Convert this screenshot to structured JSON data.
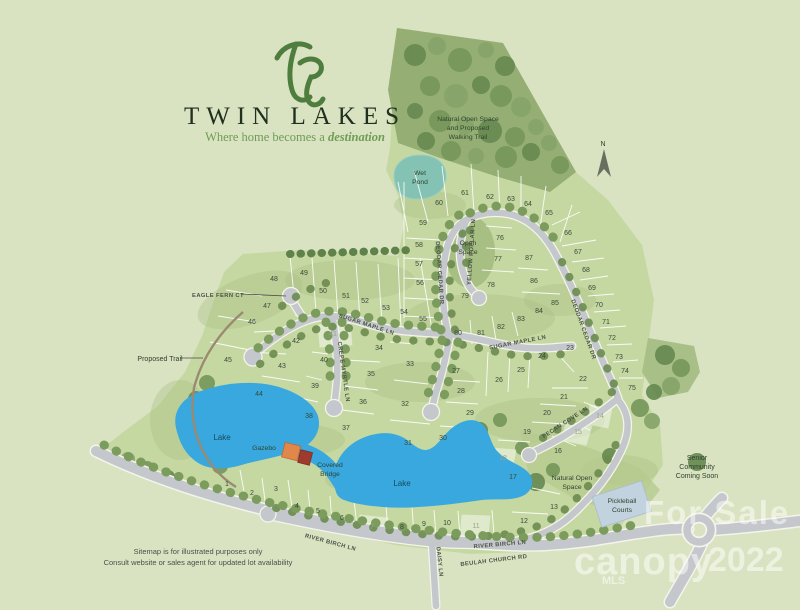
{
  "branding": {
    "name": "TWIN LAKES",
    "tagline_prefix": "Where home becomes a ",
    "tagline_emphasis": "destination"
  },
  "compass": {
    "north": "N"
  },
  "labels": {
    "natural_open_trail": [
      "Natural Open Space",
      "and Proposed",
      "Walking Trail"
    ],
    "wet_pond": [
      "Wet",
      "Pond"
    ],
    "open_space": [
      "Open",
      "Space"
    ],
    "natural_open_south": [
      "Natural Open",
      "Space"
    ],
    "lake_west": "Lake",
    "lake_east": "Lake",
    "gazebo": "Gazebo",
    "covered_bridge": [
      "Covered",
      "Bridge"
    ],
    "pickleball": [
      "Pickleball",
      "Courts"
    ],
    "senior": [
      "Senior",
      "Community",
      "Coming Soon"
    ],
    "proposed_trail": "Proposed Trail",
    "eagle_fern": "EAGLE FERN CT"
  },
  "streets": {
    "sugar_maple": "SUGAR MAPLE LN",
    "crepe_myrtle": "CREPE MYRTLE LN",
    "deodar_cedar": "DEODAR CEDAR DR",
    "yellow_poplar": "YELLOW POPLAR LN",
    "pecan_cove": "PECAN COVE LN",
    "river_birch": "RIVER BIRCH LN",
    "beulah_church": "BEULAH CHURCH RD",
    "daisy": "DAISY LN"
  },
  "disclaimer": [
    "Sitemap is for illustrated purposes only",
    "Consult website or sales agent for updated lot availability"
  ],
  "watermark": {
    "line1": "For Sale",
    "brand": "canopy",
    "year": "2022",
    "sub": "MLS"
  },
  "colors": {
    "background": "#d9e3c1",
    "site_green": "#c6d8a2",
    "forest_green": "#95ae74",
    "lake_blue": "#38a8de",
    "wet_pond_teal": "#84c3b3",
    "road_gray": "#c4c7cb",
    "logo_green": "#4e7d3e",
    "gazebo_orange": "#e2874a",
    "bridge_red": "#9e3b2e",
    "pickleball_blue": "#c2d2de"
  },
  "map": {
    "lots": [
      {
        "n": 1,
        "x": 227,
        "y": 484
      },
      {
        "n": 2,
        "x": 252,
        "y": 493
      },
      {
        "n": 3,
        "x": 276,
        "y": 489
      },
      {
        "n": 4,
        "x": 297,
        "y": 506
      },
      {
        "n": 5,
        "x": 318,
        "y": 511
      },
      {
        "n": 6,
        "x": 342,
        "y": 518
      },
      {
        "n": 7,
        "x": 372,
        "y": 527,
        "light": true
      },
      {
        "n": 8,
        "x": 402,
        "y": 527
      },
      {
        "n": 9,
        "x": 424,
        "y": 524
      },
      {
        "n": 10,
        "x": 447,
        "y": 523
      },
      {
        "n": 11,
        "x": 476,
        "y": 526,
        "light": true
      },
      {
        "n": 12,
        "x": 524,
        "y": 521
      },
      {
        "n": 13,
        "x": 554,
        "y": 507
      },
      {
        "n": 14,
        "x": 600,
        "y": 416,
        "light": true
      },
      {
        "n": 15,
        "x": 578,
        "y": 432,
        "light": true
      },
      {
        "n": 16,
        "x": 558,
        "y": 451
      },
      {
        "n": 17,
        "x": 513,
        "y": 477
      },
      {
        "n": 18,
        "x": 503,
        "y": 458,
        "light": true
      },
      {
        "n": 19,
        "x": 527,
        "y": 432
      },
      {
        "n": 20,
        "x": 547,
        "y": 413
      },
      {
        "n": 21,
        "x": 564,
        "y": 397
      },
      {
        "n": 22,
        "x": 583,
        "y": 379
      },
      {
        "n": 23,
        "x": 570,
        "y": 348
      },
      {
        "n": 24,
        "x": 542,
        "y": 356
      },
      {
        "n": 25,
        "x": 521,
        "y": 370
      },
      {
        "n": 26,
        "x": 499,
        "y": 380
      },
      {
        "n": 27,
        "x": 456,
        "y": 371
      },
      {
        "n": 28,
        "x": 461,
        "y": 391
      },
      {
        "n": 29,
        "x": 470,
        "y": 413
      },
      {
        "n": 30,
        "x": 443,
        "y": 438
      },
      {
        "n": 31,
        "x": 408,
        "y": 443
      },
      {
        "n": 32,
        "x": 405,
        "y": 404
      },
      {
        "n": 33,
        "x": 410,
        "y": 364
      },
      {
        "n": 34,
        "x": 379,
        "y": 348
      },
      {
        "n": 35,
        "x": 371,
        "y": 374
      },
      {
        "n": 36,
        "x": 363,
        "y": 402
      },
      {
        "n": 37,
        "x": 346,
        "y": 428
      },
      {
        "n": 38,
        "x": 309,
        "y": 416
      },
      {
        "n": 39,
        "x": 315,
        "y": 386
      },
      {
        "n": 40,
        "x": 324,
        "y": 360
      },
      {
        "n": 41,
        "x": 333,
        "y": 334,
        "light": true
      },
      {
        "n": 42,
        "x": 296,
        "y": 341
      },
      {
        "n": 43,
        "x": 282,
        "y": 366
      },
      {
        "n": 44,
        "x": 259,
        "y": 394
      },
      {
        "n": 45,
        "x": 228,
        "y": 360
      },
      {
        "n": 46,
        "x": 252,
        "y": 322
      },
      {
        "n": 47,
        "x": 267,
        "y": 306
      },
      {
        "n": 48,
        "x": 274,
        "y": 279
      },
      {
        "n": 49,
        "x": 304,
        "y": 273
      },
      {
        "n": 50,
        "x": 323,
        "y": 291
      },
      {
        "n": 51,
        "x": 346,
        "y": 296
      },
      {
        "n": 52,
        "x": 365,
        "y": 301
      },
      {
        "n": 53,
        "x": 386,
        "y": 308
      },
      {
        "n": 54,
        "x": 404,
        "y": 312
      },
      {
        "n": 55,
        "x": 423,
        "y": 319
      },
      {
        "n": 56,
        "x": 420,
        "y": 283
      },
      {
        "n": 57,
        "x": 419,
        "y": 264
      },
      {
        "n": 58,
        "x": 419,
        "y": 245
      },
      {
        "n": 59,
        "x": 423,
        "y": 223
      },
      {
        "n": 60,
        "x": 439,
        "y": 203
      },
      {
        "n": 61,
        "x": 465,
        "y": 193
      },
      {
        "n": 62,
        "x": 490,
        "y": 197
      },
      {
        "n": 63,
        "x": 511,
        "y": 199
      },
      {
        "n": 64,
        "x": 528,
        "y": 204
      },
      {
        "n": 65,
        "x": 549,
        "y": 213
      },
      {
        "n": 66,
        "x": 568,
        "y": 233
      },
      {
        "n": 67,
        "x": 578,
        "y": 252
      },
      {
        "n": 68,
        "x": 586,
        "y": 270
      },
      {
        "n": 69,
        "x": 592,
        "y": 288
      },
      {
        "n": 70,
        "x": 599,
        "y": 305
      },
      {
        "n": 71,
        "x": 606,
        "y": 322
      },
      {
        "n": 72,
        "x": 612,
        "y": 338
      },
      {
        "n": 73,
        "x": 619,
        "y": 357
      },
      {
        "n": 74,
        "x": 625,
        "y": 371
      },
      {
        "n": 75,
        "x": 632,
        "y": 388
      },
      {
        "n": 76,
        "x": 500,
        "y": 238
      },
      {
        "n": 77,
        "x": 498,
        "y": 259
      },
      {
        "n": 78,
        "x": 491,
        "y": 285
      },
      {
        "n": 79,
        "x": 465,
        "y": 296
      },
      {
        "n": 80,
        "x": 458,
        "y": 333
      },
      {
        "n": 81,
        "x": 481,
        "y": 333
      },
      {
        "n": 82,
        "x": 501,
        "y": 327
      },
      {
        "n": 83,
        "x": 521,
        "y": 319
      },
      {
        "n": 84,
        "x": 539,
        "y": 311
      },
      {
        "n": 85,
        "x": 555,
        "y": 303
      },
      {
        "n": 86,
        "x": 534,
        "y": 281
      },
      {
        "n": 87,
        "x": 529,
        "y": 258
      }
    ]
  }
}
